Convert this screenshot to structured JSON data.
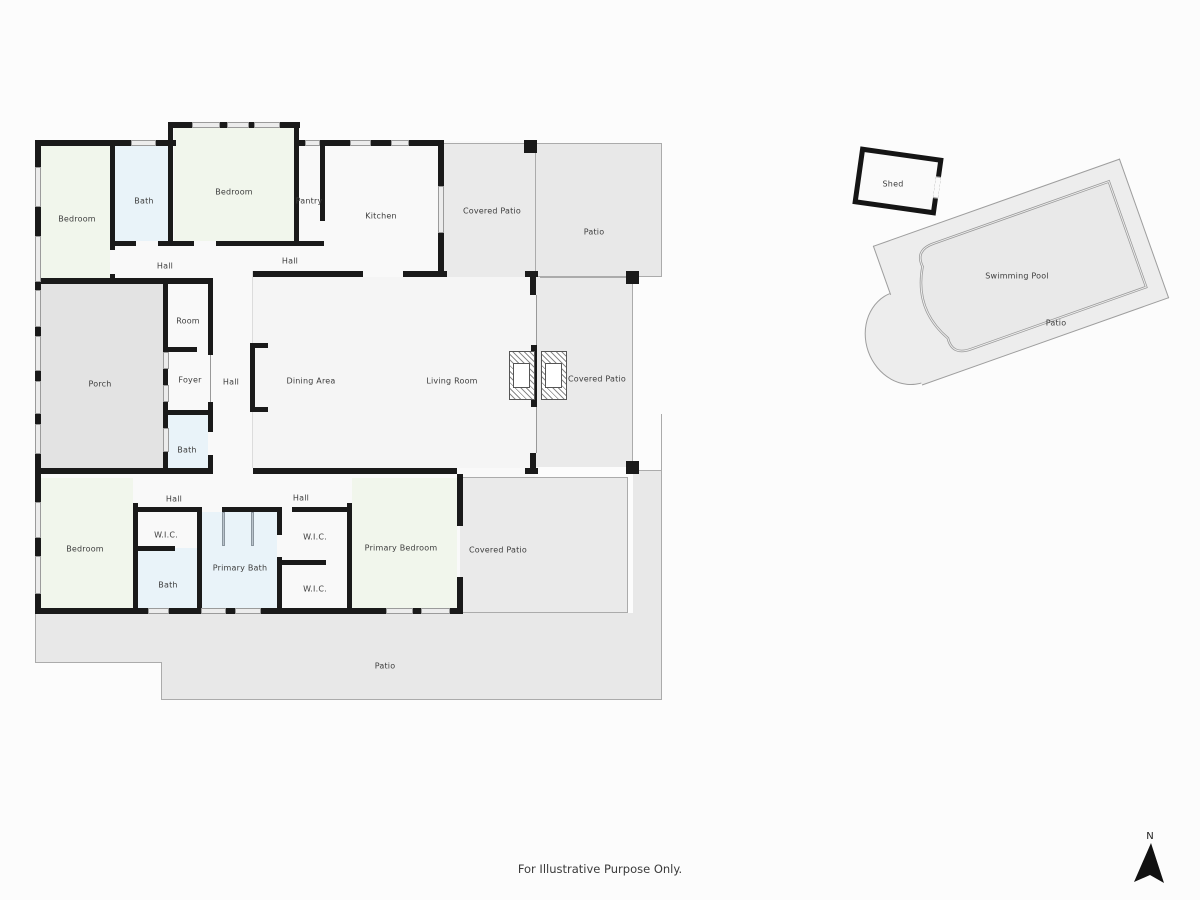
{
  "title": "Residential floor plan",
  "footer": "For Illustrative Purpose Only.",
  "compass": "N",
  "colors": {
    "wall": "#1a1a1a",
    "line": "#ababab",
    "room_fill": "#f9f9f9",
    "bedroom_fill": "#f1f6ec",
    "bath_fill": "#e9f3f9",
    "porch_fill": "#e3e3e3",
    "covered_patio_fill": "#eaeaea",
    "patio_fill": "#e8e8e8",
    "pool_fill": "#e9e9e9"
  },
  "labels": [
    "Bedroom",
    "Bath",
    "Bedroom",
    "Pantry",
    "Kitchen",
    "Covered Patio",
    "Patio",
    "Hall",
    "Hall",
    "Room",
    "Foyer",
    "Hall",
    "Porch",
    "Dining Area",
    "Living Room",
    "Covered Patio",
    "Bath",
    "Hall",
    "Hall",
    "Bedroom",
    "W.I.C.",
    "Bath",
    "Primary Bath",
    "W.I.C.",
    "W.I.C.",
    "Primary Bedroom",
    "Covered Patio",
    "Patio",
    "Shed",
    "Swimming Pool",
    "Patio"
  ]
}
